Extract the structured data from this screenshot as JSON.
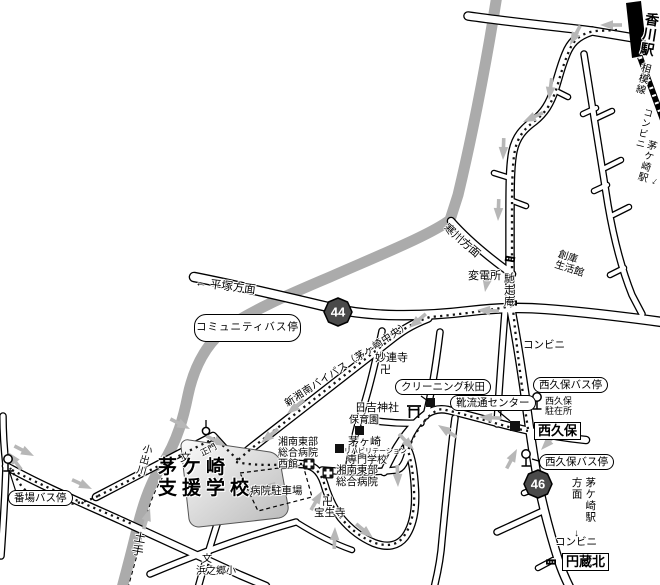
{
  "stations": {
    "kagawa": "香川駅",
    "line_name": "相模線",
    "chigasaki": "茅ケ崎駅"
  },
  "shields": {
    "r44": "44",
    "r46": "46"
  },
  "directions": {
    "hiratsuka": "← 平塚方面",
    "samukawa": "寒川方面",
    "chigasaki_station_dir": "茅ケ崎駅\n方面",
    "down_arrow": "↓"
  },
  "roads": {
    "bypass": "新湘南バイパス（茅ヶ崎中央）",
    "dote": "土手",
    "koide_river": "小出川"
  },
  "intersections": {
    "nishikubo": "西久保",
    "enzokita": "円蔵北"
  },
  "bus_stops": {
    "community": "コミュニティバス停",
    "bamba": "番場バス停",
    "nishikubo_upper": "西久保バス停",
    "nishikubo_lower": "西久保バス停"
  },
  "landmarks": {
    "substation": "変電所",
    "chisouan": "馳走庵",
    "souko_seikatsukan": "創庫\n生活館",
    "conbini_top": "コンビニ",
    "conbini_mid": "コンビニ",
    "conbini_bottom": "コンビニ",
    "cleaning_akita": "クリーニング秋田",
    "shoe_center": "靴流通センター",
    "police_box": "西久保\n駐在所",
    "myorenji": "妙連寺",
    "hiyoshi_jinja": "日吉神社",
    "hoikuen": "保育園",
    "rehab_l1": "茅ヶ崎",
    "rehab_l2": "リハビリテーション",
    "rehab_l3": "専門学校",
    "hospital_west": "湘南東部\n総合病院\n西館",
    "hospital": "湘南東部\n総合病院",
    "parking": "病院駐車場",
    "hoshoji": "宝生寺",
    "hamanogo": "浜之郷小",
    "seimon": "正門"
  },
  "school": {
    "name": "茅ケ崎\n支援学校"
  },
  "symbols": {
    "temple_manji": "卍",
    "school_mark": "文"
  },
  "colors": {
    "river": "#ababab",
    "arrow": "#b7b7b7",
    "shield_fill": "#4a4a4a",
    "route_dot": "#141414",
    "building": "#111111"
  }
}
